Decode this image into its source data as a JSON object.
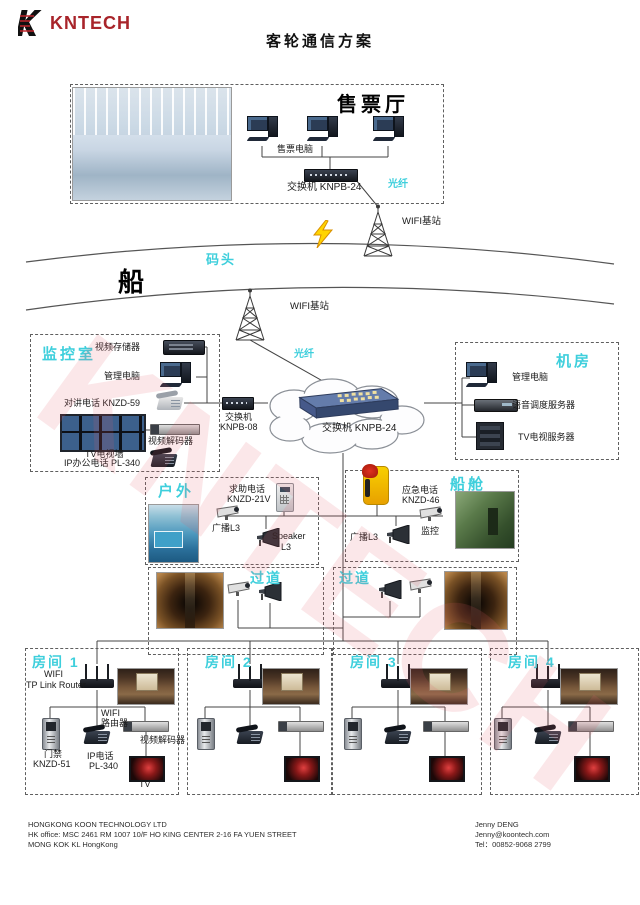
{
  "header": {
    "logo": "KNTECH",
    "title": "客轮通信方案"
  },
  "ticket_hall": {
    "title": "售票厅",
    "computers": "售票电脑",
    "switch": "交换机 KNPB-24",
    "fiber": "光纤",
    "wifi_station": "WIFI基站"
  },
  "shore": {
    "dock": "码头",
    "ship": "船",
    "wifi_station": "WIFI基站",
    "fiber": "光纤"
  },
  "monitor_room": {
    "title": "监控室",
    "video_storage": "视频存储器",
    "mgmt_pc": "管理电脑",
    "intercom": "对讲电话 KNZD-59",
    "tv_wall": "TV电视墙",
    "decoder": "视频解码器",
    "office_phone": "IP办公电话 PL-340"
  },
  "core": {
    "switch8_l1": "交换机",
    "switch8_l2": "KNPB-08",
    "switch24": "交换机 KNPB-24"
  },
  "machine_room": {
    "title": "机房",
    "mgmt_pc": "管理电脑",
    "voice_server": "语音调度服务器",
    "tv_server": "TV电视服务器"
  },
  "outdoor": {
    "title": "户外",
    "help_l1": "求助电话",
    "help_l2": "KNZD-21V",
    "broadcast": "广播L3",
    "speaker_l1": "Speaker",
    "speaker_l2": "L3"
  },
  "cabin": {
    "title": "船舱",
    "emg_l1": "应急电话",
    "emg_l2": "KNZD-46",
    "broadcast": "广播L3",
    "camera": "监控"
  },
  "corridors": {
    "c1": "过道",
    "c2": "过道"
  },
  "rooms": {
    "r1": {
      "title": "房间 1",
      "wifi_l1": "WIFI",
      "wifi_l2": "TP Link Router",
      "router_l1": "WIFI",
      "router_l2": "路由器",
      "door_l1": "门禁",
      "door_l2": "KNZD-51",
      "phone_l1": "IP电话",
      "phone_l2": "PL-340",
      "decoder": "视频解码器",
      "tv": "TV"
    },
    "r2": {
      "title": "房间 2"
    },
    "r3": {
      "title": "房间 3"
    },
    "r4": {
      "title": "房间 4"
    }
  },
  "footer": {
    "company": "HONGKONG KOON TECHNOLOGY LTD",
    "address1": "HK office: MSC 2461 RM 1007 10/F HO KING CENTER 2-16 FA YUEN STREET",
    "address2": "MONG KOK KL HongKong",
    "contact": "Jenny DENG",
    "email": "Jenny@koontech.com",
    "tel": "Tel：00852-9068 2799"
  },
  "watermark": "KNTECH",
  "colors": {
    "accent_cyan": "#3ecfdc",
    "logo_red": "#a8242a",
    "watermark_pink": "#e85a64"
  }
}
